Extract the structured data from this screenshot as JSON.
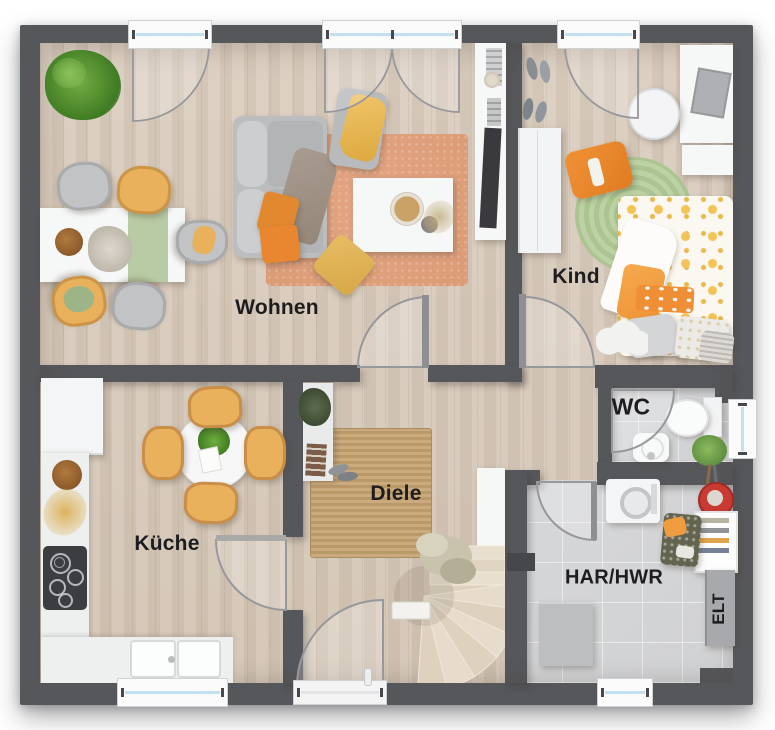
{
  "labels": {
    "living": "Wohnen",
    "child": "Kind",
    "kitchen": "Küche",
    "hallway": "Diele",
    "wc": "WC",
    "utility": "HAR/HWR",
    "electrical": "ELT"
  },
  "colors": {
    "wall": "#56575b",
    "wood_floor": "#d6c8b8",
    "tile_floor": "#d6d7d9",
    "rug_living": "#e3a583",
    "rug_hall": "#c6a477",
    "rug_child": "#b7cd9d",
    "accent_yellow": "#e9b15c",
    "accent_orange": "#e8872f",
    "window_glass": "#c2e0f0",
    "door_arc": "#97989c",
    "label_text": "#1d1d1f"
  }
}
